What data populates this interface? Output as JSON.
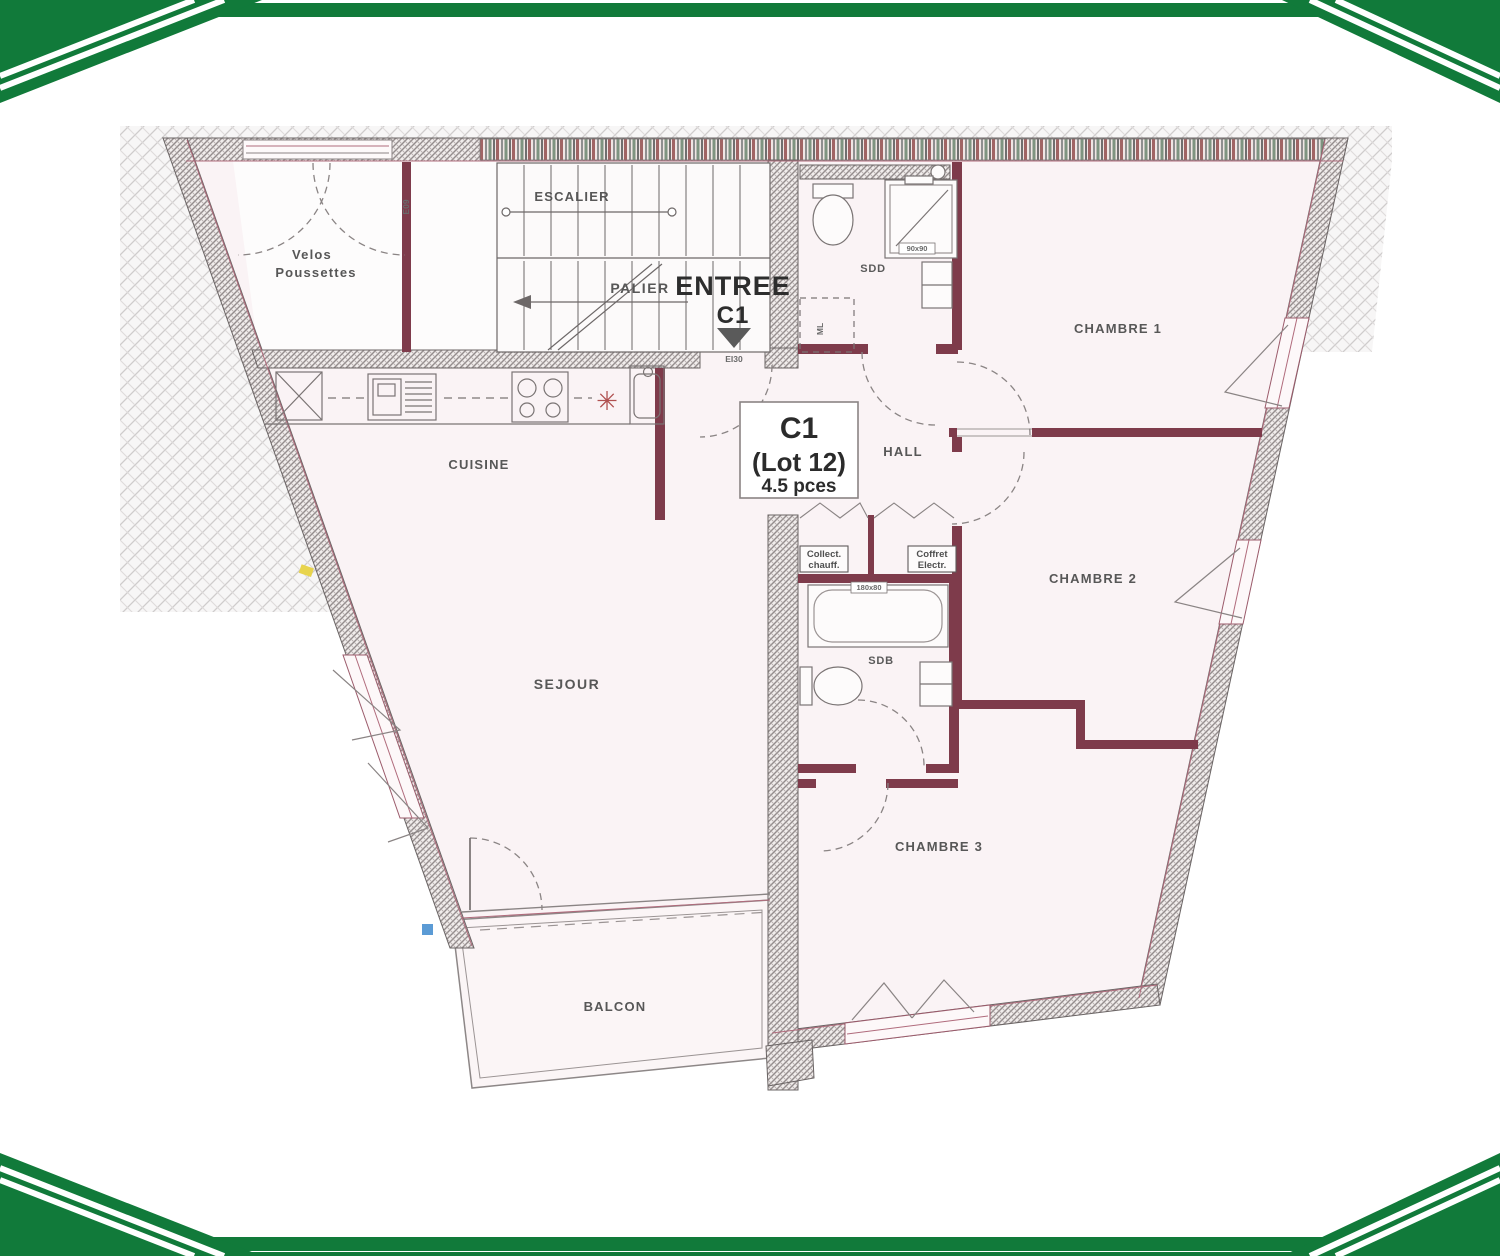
{
  "colors": {
    "frame_green": "#117a3a",
    "wall_maroon": "#7e3b4b",
    "floor_pink": "#faf3f5",
    "window_pink": "#b06b7c",
    "marker_yellow": "#e8d44d",
    "marker_blue": "#5b9bd5",
    "asterisk_red": "#b05050"
  },
  "plan": {
    "unit_label": {
      "line1": "C1",
      "line2": "(Lot 12)",
      "line3": "4.5 pces"
    },
    "entrance": {
      "title": "ENTREE",
      "unit": "C1",
      "fire_rating": "EI30",
      "door_tag": "E09"
    },
    "rooms": {
      "velos_line1": "Velos",
      "velos_line2": "Poussettes",
      "palier": "PALIER",
      "escalier": "ESCALIER",
      "sdd": "SDD",
      "ml": "ML",
      "chambre1": "CHAMBRE 1",
      "cuisine": "CUISINE",
      "hall": "HALL",
      "chambre2": "CHAMBRE 2",
      "sejour": "SEJOUR",
      "sdb": "SDB",
      "chambre3": "CHAMBRE 3",
      "balcon": "BALCON"
    },
    "closets": {
      "left_line1": "Collect.",
      "left_line2": "chauff.",
      "right_line1": "Coffret",
      "right_line2": "Electr."
    },
    "fixtures": {
      "shower_size": "90x90",
      "bath_size": "180x80"
    }
  }
}
